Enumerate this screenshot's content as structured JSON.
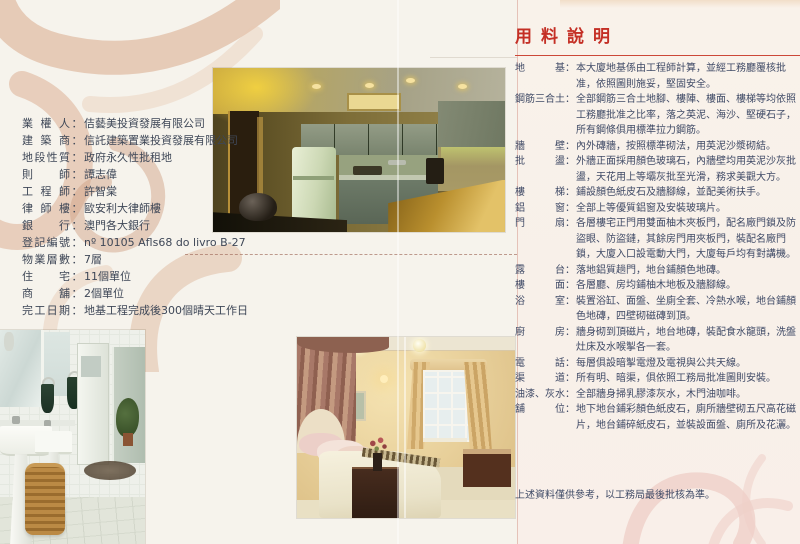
{
  "ui": {
    "colon": "："
  },
  "colors": {
    "accent_red": "#c42f25",
    "page_bg": "#f6f3ec",
    "text": "#3f4a66"
  },
  "left_info": {
    "rows": [
      {
        "label": "業權人",
        "value": "佶藝美投資發展有限公司"
      },
      {
        "label": "建築商",
        "value": "信託建築置業投資發展有限公司"
      },
      {
        "label": "地段性質",
        "value": "政府永久性批租地"
      },
      {
        "label": "則師",
        "value": "譚志偉"
      },
      {
        "label": "工程師",
        "value": "許智棠"
      },
      {
        "label": "律師樓",
        "value": "歐安利大律師樓"
      },
      {
        "label": "銀行",
        "value": "澳門各大銀行"
      },
      {
        "label": "登記編號",
        "value": "nº 10105 Afls68 do livro B-27"
      },
      {
        "label": "物業層數",
        "value": "7層"
      },
      {
        "label": "住宅",
        "value": "11個單位"
      },
      {
        "label": "商舖",
        "value": "2個單位"
      },
      {
        "label": "完工日期",
        "value": "地基工程完成後300個晴天工作日"
      }
    ]
  },
  "spec": {
    "title": "用料說明",
    "items": [
      {
        "label": "地基",
        "text": "本大廈地基係由工程師計算，並經工務廳覆核批准，依照圖則施妥，堅固安全。"
      },
      {
        "label": "鋼筋三合土",
        "text": "全部鋼筋三合土地腳、樓陣、樓面、樓梯等均依照工務廳批准之比率，落之英泥、海沙、堅硬石子，所有鋼條俱用標準拉力鋼筋。"
      },
      {
        "label": "牆壁",
        "text": "內外磚牆，按照標準砌法，用英泥沙漿砌結。"
      },
      {
        "label": "批盪",
        "text": "外牆正面採用顏色玻璃石，內牆壁均用英泥沙灰批盪，天花用上等壩灰批至光滑，務求美觀大方。"
      },
      {
        "label": "樓梯",
        "text": "鋪設顏色紙皮石及牆腳線，並配美術扶手。"
      },
      {
        "label": "鋁窗",
        "text": "全部上等優質鋁窗及安裝玻璃片。"
      },
      {
        "label": "門扇",
        "text": "各層樓宅正門用雙面柚木夾板門，配名廠門鎖及防盜眼、防盜鏈，其餘房門用夾板門，裝配名廠門鎖，大廈入口設電動大門，大廈每戶均有對講機。"
      },
      {
        "label": "露台",
        "text": "落地鋁質趟門，地台鋪顏色地磚。"
      },
      {
        "label": "樓面",
        "text": "各層廳、房均鋪柚木地板及牆腳線。"
      },
      {
        "label": "浴室",
        "text": "裝置浴缸、面盤、坐廁全套、冷熱水喉，地台鋪顏色地磚，四壁砌磁磚到頂。"
      },
      {
        "label": "廚房",
        "text": "牆身砌到頂磁片，地台地磚，裝配食水龍頭，洗盤灶床及水喉掣各一套。"
      },
      {
        "label": "電話",
        "text": "每層俱設暗掣電燈及電視與公共天線。"
      },
      {
        "label": "渠道",
        "text": "所有明、暗渠，俱依照工務局批准圖則安裝。"
      },
      {
        "label": "油漆、灰水",
        "text": "全部牆身掃乳膠漆灰水，木門油咖啡。"
      },
      {
        "label": "舖位",
        "text": "地下地台鋪彩顏色紙皮石，廁所牆壁砌五尺高花磁片，地台鋪碎紙皮石，並裝設面盤、廁所及花灑。"
      }
    ],
    "footer": "上述資料僅供參考，以工務局最後批核為準。"
  }
}
